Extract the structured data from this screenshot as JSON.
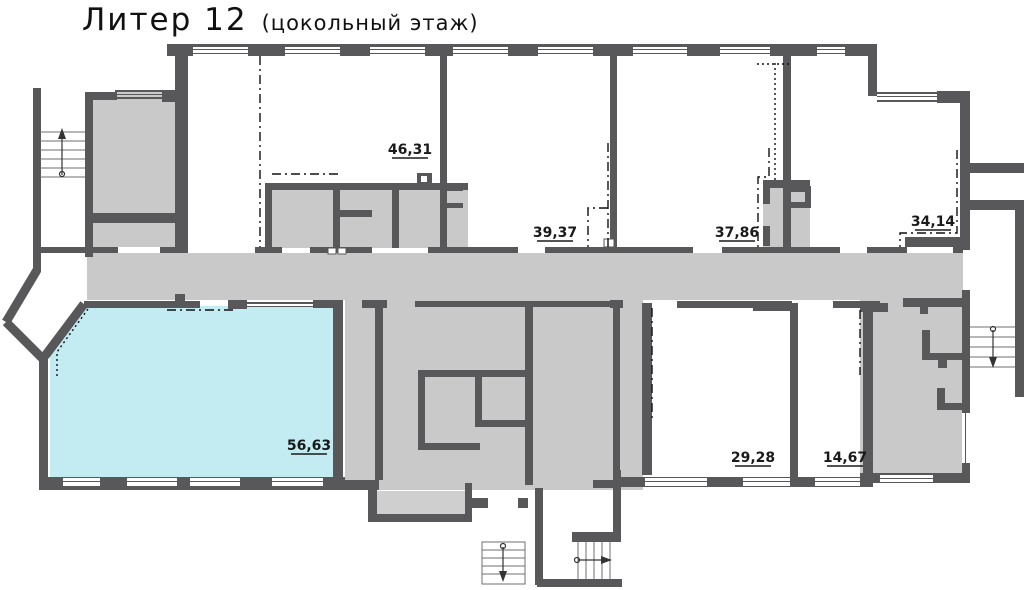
{
  "title": {
    "main": "Литер 12",
    "sub": "(цокольный этаж)"
  },
  "floor_plan": {
    "floor": "цокольный этаж",
    "building": "Литер 12",
    "rooms": [
      {
        "id": "room-46-31",
        "area_label": "46,31",
        "highlighted": false
      },
      {
        "id": "room-39-37",
        "area_label": "39,37",
        "highlighted": false
      },
      {
        "id": "room-37-86",
        "area_label": "37,86",
        "highlighted": false
      },
      {
        "id": "room-34-14",
        "area_label": "34,14",
        "highlighted": false
      },
      {
        "id": "room-56-63",
        "area_label": "56,63",
        "highlighted": true
      },
      {
        "id": "room-29-28",
        "area_label": "29,28",
        "highlighted": false
      },
      {
        "id": "room-14-67",
        "area_label": "14,67",
        "highlighted": false
      }
    ],
    "stairs": [
      {
        "id": "stair-left",
        "direction": "up"
      },
      {
        "id": "stair-right",
        "direction": "down"
      },
      {
        "id": "stair-bottom-left",
        "direction": "down"
      },
      {
        "id": "stair-bottom-right",
        "direction": "right"
      }
    ],
    "colors": {
      "highlight": "#c2ebf2",
      "walls": "#58585a",
      "common_area": "#c9c9c9"
    }
  }
}
